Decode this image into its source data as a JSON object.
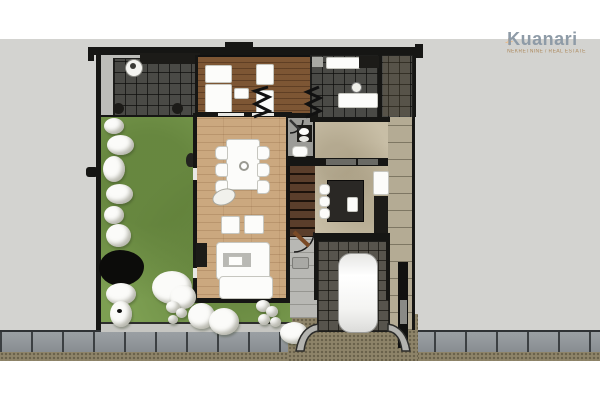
{
  "logo": {
    "brand": "Kuanari",
    "tagline": "NEKRETNINE / REAL ESTATE"
  },
  "icons": {
    "logo_star": "four-point-sparkle"
  },
  "palette": {
    "backdrop_gray": "#d3d3d0",
    "wall_black": "#161614",
    "lawn_green": "#7d9f52",
    "deck_wood": "#7d5634",
    "interior_wood": "#cba87f",
    "dark_tile": "#4a4a46",
    "garage_tile": "#57544d",
    "beige_floor": "#c8bea6",
    "sidewalk_gray": "#91969a",
    "gravel_brown": "#8e8469",
    "car_white": "#ffffff",
    "logo_star_orange": "#f2bd8d",
    "logo_text_blue_gray": "#8e9ba7"
  }
}
